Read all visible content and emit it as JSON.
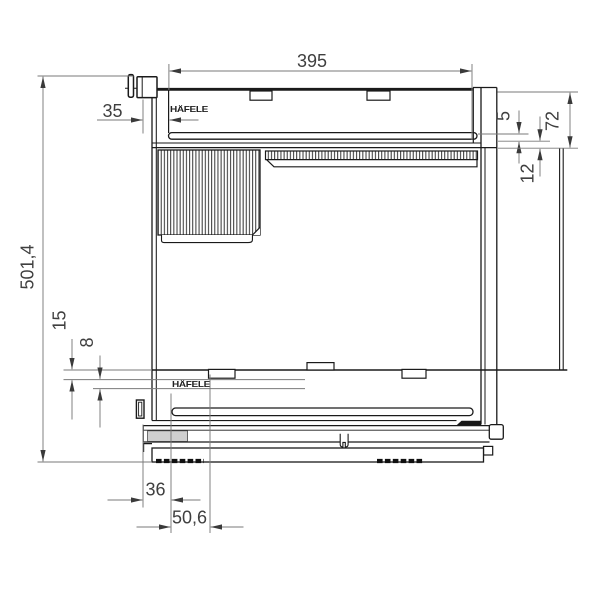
{
  "brand": {
    "logo_top": "HÄFELE",
    "logo_bottom": "HÄFELE"
  },
  "dimensions": {
    "overall_height": "501,4",
    "top_width": "395",
    "front_setback": "35",
    "rail_gap": "5",
    "profile_height": "72",
    "rail_drop": "12",
    "panel_step": "15",
    "panel_gap": "8",
    "runner_setback": "36",
    "runner_front_offset": "50,6"
  },
  "colors": {
    "line": "#1a1a1a",
    "dimension_line": "#7a7a7a",
    "label_text": "#3f3f3f",
    "background": "#ffffff",
    "shaded_block": "#cfcfcf",
    "wedge_fill": "#161616"
  }
}
